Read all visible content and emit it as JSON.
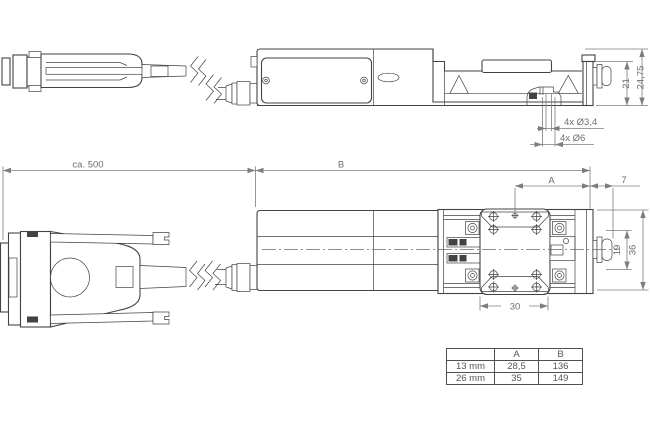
{
  "colors": {
    "background": "#ffffff",
    "line_dark": "#434343",
    "line_dim": "#7d7d7d",
    "text_dim": "#6f6f6f",
    "table_border": "#4f4f4f",
    "table_text": "#565656"
  },
  "side_view": {
    "dim_height_total": "24,75",
    "dim_height_carriage": "21",
    "holes_small": "4x Ø3,4",
    "holes_large": "4x Ø6"
  },
  "top_view": {
    "dim_cable_length": "ca. 500",
    "dim_b_label": "B",
    "dim_a_label": "A",
    "dim_overhang": "7",
    "dim_plate_width": "30",
    "dim_pitch": "19",
    "dim_total_width": "36"
  },
  "variant_table": {
    "col_headers": [
      "A",
      "B"
    ],
    "rows": [
      {
        "variant": "13 mm",
        "a": "28,5",
        "b": "136"
      },
      {
        "variant": "26 mm",
        "a": "35",
        "b": "149"
      }
    ]
  }
}
